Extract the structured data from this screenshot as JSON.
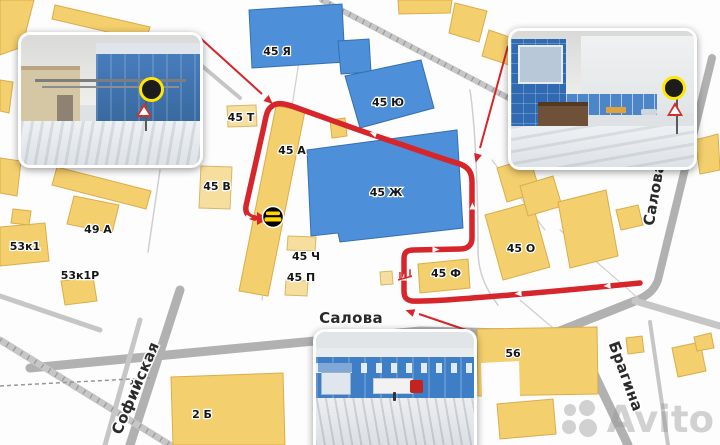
{
  "map": {
    "building_labels": [
      {
        "text": "45 Я"
      },
      {
        "text": "45 Ю"
      },
      {
        "text": "45 Ж"
      },
      {
        "text": "45 Т"
      },
      {
        "text": "45 А"
      },
      {
        "text": "45 В"
      },
      {
        "text": "45 Ч"
      },
      {
        "text": "45 П"
      },
      {
        "text": "45 Ф"
      },
      {
        "text": "45 О"
      },
      {
        "text": "49 А"
      },
      {
        "text": "53к1"
      },
      {
        "text": "53к1Р"
      },
      {
        "text": "2 Б"
      },
      {
        "text": "56"
      }
    ],
    "street_labels": [
      {
        "text": "Салова"
      },
      {
        "text": "Софийская"
      },
      {
        "text": "Брагина"
      },
      {
        "text": "Салова"
      }
    ],
    "colors": {
      "building_yellow": "#F4CF6E",
      "building_yellow_light": "#F6DE9E",
      "building_blue": "#4D8FD9",
      "road_gray": "#B1B1B1",
      "route_red": "#D6252B",
      "route_arrow_white": "#FFFFFF",
      "logo_circle_black": "#000000",
      "logo_text_yellow": "#FFD400",
      "sign_highlight_yellow": "#FFE600"
    },
    "route": {
      "description": "Red driving route with white direction arrows: enters at Салова/Брагина corner, runs west along Салова, turns north, loops clockwise around building 45 Ж and ends with an arrow at the black circular logo on building 45 А",
      "photo_pointer_arrows": 3
    },
    "icons": [
      {
        "name": "destination-logo",
        "style": "black circle with yellow text, on building 45 А"
      },
      {
        "name": "barrier-icon",
        "color": "#D6252B"
      }
    ]
  },
  "photos": [
    {
      "position": "top-left",
      "subject": "snowy gate entrance between beige and blue industrial buildings, overhead pipe gantry, warning triangle, sign circled in yellow"
    },
    {
      "position": "top-right",
      "subject": "snowy curve with tall blue building, large white warehouse, blue garage row, brown shed, road signs circled in yellow"
    },
    {
      "position": "bottom-center",
      "subject": "snowy driveway along long blue warehouse with window strip, red truck with white trailer, small canopy kiosk"
    }
  ],
  "watermark": {
    "text": "Avito"
  }
}
